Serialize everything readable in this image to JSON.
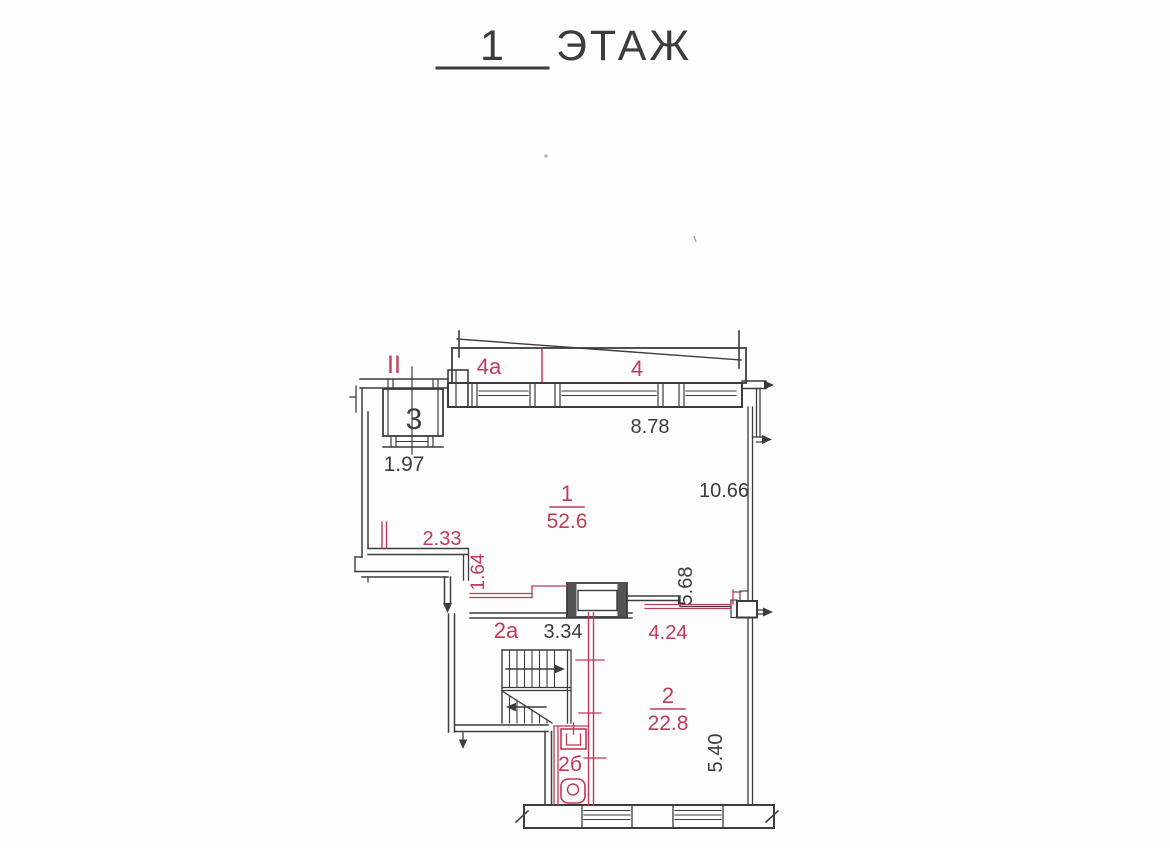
{
  "palette": {
    "ink": "#3c3c3c",
    "red": "#c13a56",
    "paper": "#fdfdfd"
  },
  "title": {
    "number": "1",
    "word": "ЭТАЖ"
  },
  "plan": {
    "rooms": {
      "r1": {
        "number": "1",
        "area": "52.6"
      },
      "r2": {
        "number": "2",
        "area": "22.8"
      },
      "r2a": {
        "label": "2а"
      },
      "r2b": {
        "label": "2б"
      },
      "r3": {
        "label": "3"
      },
      "r4": {
        "label": "4"
      },
      "r4a": {
        "label": "4а"
      },
      "entrance_marker": {
        "label": "II"
      }
    },
    "dimensions": {
      "w197": "1.97",
      "w233": "2.33",
      "w164": "1.64",
      "w878": "8.78",
      "w1066": "10.66",
      "w568": "5.68",
      "w334": "3.34",
      "w424": "4.24",
      "w540": "5.40"
    }
  }
}
